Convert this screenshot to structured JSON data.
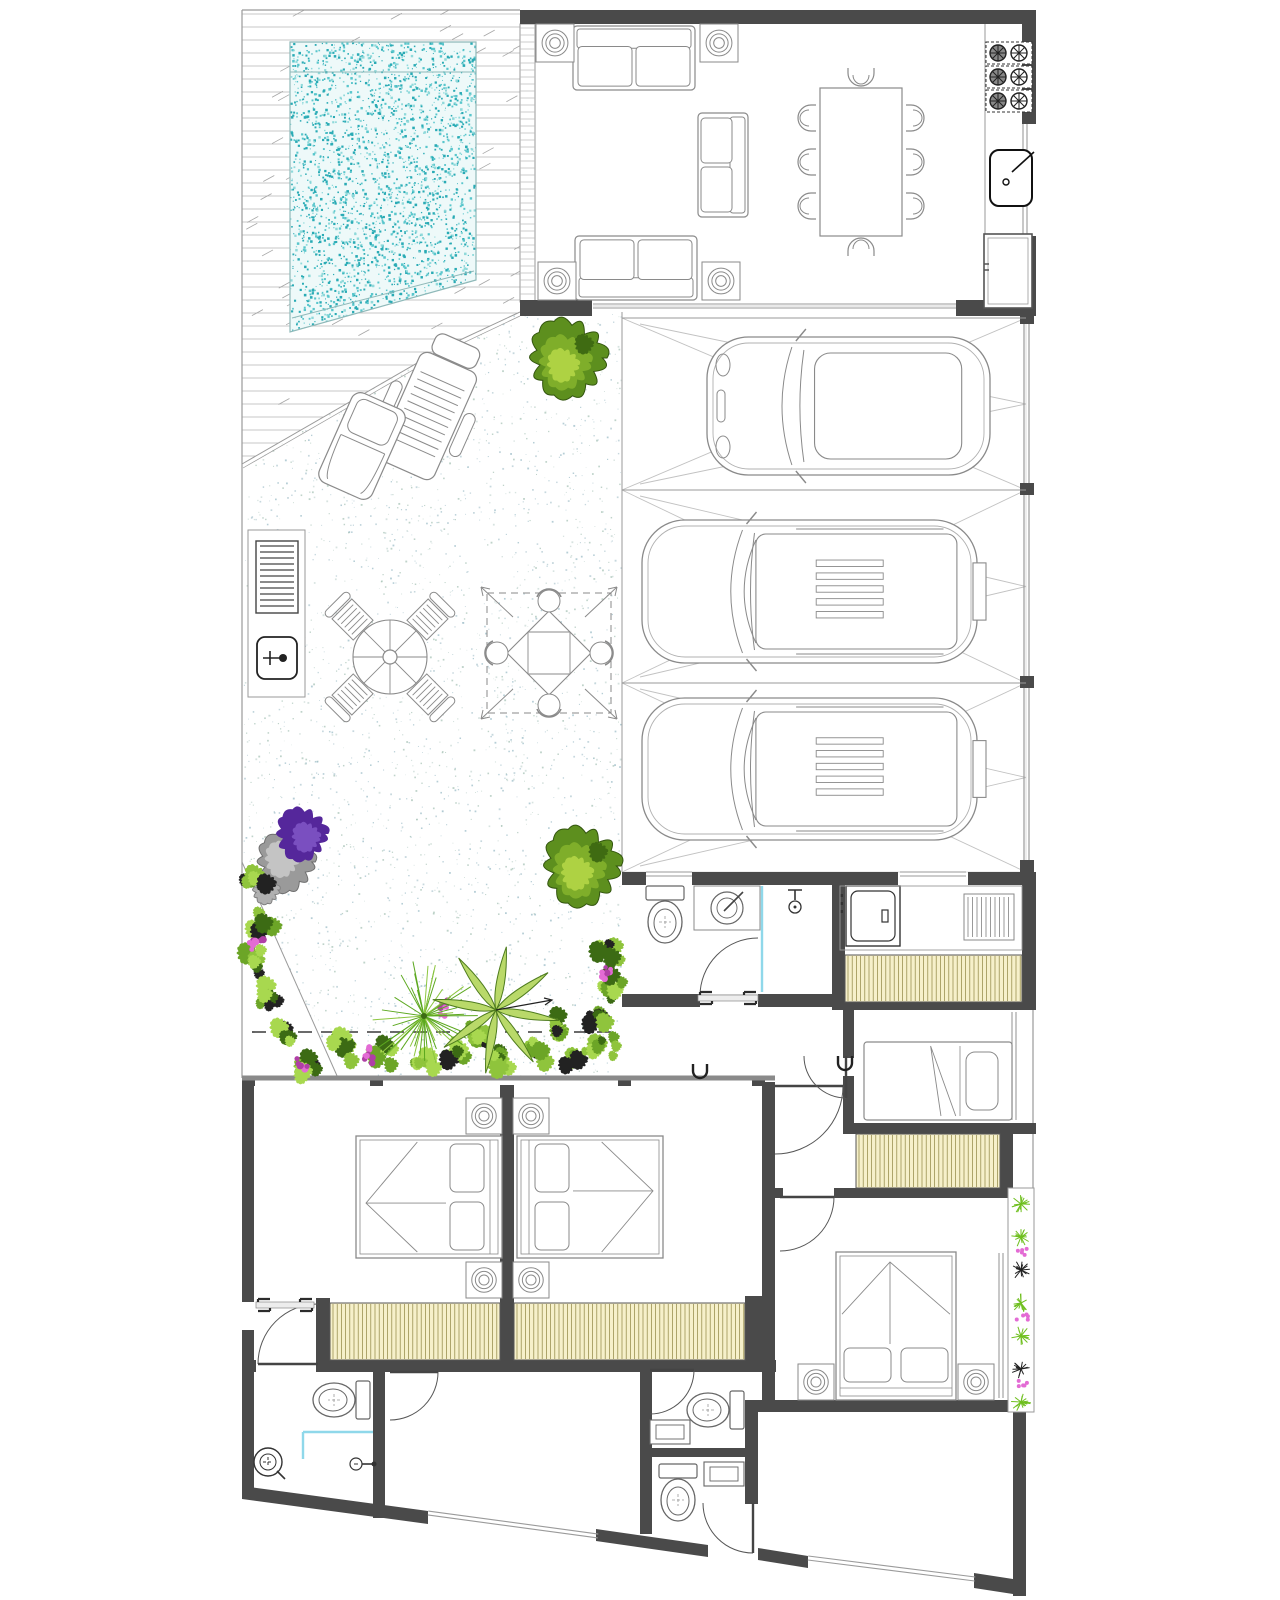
{
  "canvas": {
    "w": 1280,
    "h": 1600,
    "bg": "#ffffff"
  },
  "palette": {
    "wall": "#4a4a4a",
    "thin": "#9a9a9a",
    "mid": "#8a8a8a",
    "furn": "#8a8a8a",
    "furn2": "#666666",
    "poolBase": "#eef9f9",
    "poolDot1": "#2aabb5",
    "poolDot2": "#59c6cc",
    "poolDot3": "#8fd9da",
    "poolEdge": "#8fb9b9",
    "deckLine": "#b5b5b5",
    "deckTick": "#a6a6a6",
    "patioDots": [
      "#a9c3cd",
      "#9cbcae",
      "#c2d4cf",
      "#8fb3c0"
    ],
    "bayLine": "#c2c2c2",
    "gate": "#9a9a9a",
    "closetBg": "#f6f0ca",
    "closetLine": "#8e8440",
    "closetEdge": "#555555",
    "cyan": "#8fd8ea",
    "dash": "#3a3a3a",
    "treeDark": "#5d8f1e",
    "treeMid": "#7fae2a",
    "treeLight": "#aed243",
    "treeDeep": "#3f6b12",
    "bushGreens": [
      "#8fc43c",
      "#6ca527",
      "#a8d84f",
      "#3c6b14",
      "#222222"
    ],
    "pink": "#e36bd4",
    "pink2": "#b03fa6",
    "purple": "#55279b",
    "purple2": "#7a4fc0",
    "rock1": "#9a9a9a",
    "rock2": "#c4c4c4",
    "door": "#555555",
    "leaf": "#444444"
  },
  "site": {
    "topEdge": [
      242,
      10,
      520,
      10
    ],
    "leftEdge": [
      242,
      10,
      242,
      1078
    ],
    "rightThin": [
      1033,
      1006,
      1033,
      1192
    ],
    "gardenCutLine": [
      242,
      862,
      338,
      1078
    ],
    "dashedLine": [
      252,
      1032,
      612,
      1032
    ]
  },
  "floors": {
    "deck": {
      "poly": [
        [
          242,
          10
        ],
        [
          520,
          10
        ],
        [
          520,
          312
        ],
        [
          445,
          347
        ],
        [
          242,
          464
        ]
      ],
      "edge1": [
        [
          520,
          312
        ],
        [
          445,
          347
        ],
        [
          242,
          464
        ]
      ],
      "edge2": [
        [
          520,
          316
        ],
        [
          446,
          351
        ],
        [
          243,
          468
        ]
      ],
      "lineStep": 13,
      "ticks": 80
    },
    "pool": {
      "poly": [
        [
          290,
          42
        ],
        [
          476,
          42
        ],
        [
          476,
          280
        ],
        [
          290,
          332
        ]
      ],
      "steps": [
        [
          290,
          72,
          476,
          72
        ],
        [
          292,
          318,
          474,
          271
        ]
      ],
      "dots": 2600
    },
    "patio": {
      "poly": [
        [
          242,
          464
        ],
        [
          445,
          347
        ],
        [
          520,
          312
        ],
        [
          622,
          312
        ],
        [
          622,
          1078
        ],
        [
          242,
          1078
        ]
      ],
      "dots": 3000
    },
    "whiteCut": {
      "poly": [
        [
          242,
          862
        ],
        [
          338,
          1078
        ],
        [
          242,
          1078
        ]
      ]
    },
    "louver": {
      "x": 520,
      "y": 24,
      "w": 15,
      "h": 278,
      "step": 7
    },
    "garage": {
      "x0": 622,
      "x1": 1026,
      "bays": [
        [
          318,
          490
        ],
        [
          490,
          683
        ],
        [
          683,
          872
        ]
      ]
    },
    "gates": {
      "lines": [
        [
          1024,
          318,
          1024,
          872
        ],
        [
          1029,
          318,
          1029,
          872
        ]
      ],
      "posts": [
        [
          1020,
          312,
          14,
          12
        ],
        [
          1020,
          483,
          14,
          12
        ],
        [
          1020,
          676,
          14,
          12
        ],
        [
          1020,
          860,
          14,
          12
        ]
      ]
    },
    "slidingGlass": {
      "x1": 593,
      "x2": 956,
      "y": 306
    }
  },
  "walls": [
    [
      520,
      10,
      516,
      14
    ],
    [
      1022,
      10,
      14,
      114
    ],
    [
      1022,
      236,
      14,
      80
    ],
    [
      520,
      300,
      72,
      16
    ],
    [
      956,
      300,
      80,
      16
    ],
    [
      622,
      872,
      24,
      13
    ],
    [
      692,
      872,
      206,
      13
    ],
    [
      968,
      872,
      68,
      13
    ],
    [
      832,
      885,
      13,
      110
    ],
    [
      622,
      994,
      78,
      13
    ],
    [
      758,
      994,
      74,
      13
    ],
    [
      1022,
      885,
      14,
      121
    ],
    [
      832,
      950,
      13,
      58
    ],
    [
      832,
      1002,
      204,
      8
    ],
    [
      843,
      1010,
      11,
      48
    ],
    [
      843,
      1076,
      11,
      49
    ],
    [
      843,
      1123,
      193,
      11
    ],
    [
      1000,
      1134,
      13,
      56
    ],
    [
      775,
      1188,
      8,
      10
    ],
    [
      834,
      1188,
      188,
      10
    ],
    [
      762,
      1082,
      13,
      330
    ],
    [
      500,
      1085,
      14,
      280
    ],
    [
      242,
      1082,
      12,
      220
    ],
    [
      242,
      1330,
      12,
      36
    ],
    [
      242,
      1360,
      14,
      12
    ],
    [
      316,
      1360,
      460,
      12
    ],
    [
      316,
      1298,
      14,
      74
    ],
    [
      745,
      1296,
      17,
      76
    ],
    [
      745,
      1400,
      277,
      12
    ],
    [
      242,
      1368,
      12,
      122
    ],
    [
      373,
      1368,
      12,
      150
    ],
    [
      640,
      1368,
      12,
      88
    ],
    [
      640,
      1448,
      105,
      9
    ],
    [
      640,
      1452,
      12,
      82
    ],
    [
      745,
      1412,
      13,
      92
    ],
    [
      1013,
      1412,
      13,
      184
    ],
    [
      242,
      1076,
      13,
      10
    ],
    [
      370,
      1076,
      13,
      10
    ],
    [
      618,
      1076,
      13,
      10
    ],
    [
      752,
      1076,
      13,
      10
    ]
  ],
  "wallPolys": [
    [
      [
        242,
        1486
      ],
      [
        428,
        1511
      ],
      [
        428,
        1524
      ],
      [
        242,
        1499
      ]
    ],
    [
      [
        596,
        1529
      ],
      [
        708,
        1545
      ],
      [
        708,
        1557
      ],
      [
        596,
        1541
      ]
    ],
    [
      [
        758,
        1548
      ],
      [
        808,
        1556
      ],
      [
        808,
        1568
      ],
      [
        758,
        1560
      ]
    ],
    [
      [
        974,
        1573
      ],
      [
        1026,
        1581
      ],
      [
        1026,
        1596
      ],
      [
        974,
        1588
      ]
    ]
  ],
  "grayWalls": [
    [
      242,
      1078,
      775,
      1078
    ]
  ],
  "windows": [
    [
      1025,
      124,
      1025,
      236
    ],
    [
      646,
      874,
      692,
      874
    ],
    [
      900,
      874,
      966,
      874
    ],
    [
      1014,
      1012,
      1014,
      1120
    ],
    [
      1001,
      1253,
      1001,
      1398
    ],
    [
      428,
      1513,
      598,
      1536
    ],
    [
      808,
      1558,
      975,
      1579
    ]
  ],
  "thin": [
    [
      622,
      312,
      622,
      872
    ],
    [
      985,
      24,
      985,
      300
    ],
    [
      622,
      318,
      1026,
      318
    ],
    [
      622,
      490,
      1026,
      490
    ],
    [
      622,
      683,
      1026,
      683
    ]
  ],
  "cyan": [
    [
      762,
      886,
      762,
      992
    ],
    [
      303,
      1432,
      373,
      1432
    ],
    [
      303,
      1432,
      303,
      1459
    ]
  ],
  "closets": [
    [
      845,
      955,
      177,
      47
    ],
    [
      856,
      1134,
      144,
      54
    ],
    [
      330,
      1303,
      170,
      57
    ],
    [
      514,
      1303,
      231,
      57
    ]
  ],
  "doors": [
    {
      "hx": 758,
      "hy": 996,
      "r": 58,
      "a0": 180,
      "a1": 270
    },
    {
      "hx": 775,
      "hy": 1086,
      "r": 68,
      "a0": 0,
      "a1": 90
    },
    {
      "hx": 846,
      "hy": 1056,
      "r": 42,
      "a0": 90,
      "a1": 180
    },
    {
      "hx": 780,
      "hy": 1197,
      "r": 54,
      "a0": 0,
      "a1": 90
    },
    {
      "hx": 318,
      "hy": 1364,
      "r": 60,
      "a0": 180,
      "a1": 270
    },
    {
      "hx": 390,
      "hy": 1372,
      "r": 48,
      "a0": 0,
      "a1": 90
    },
    {
      "hx": 650,
      "hy": 1370,
      "r": 44,
      "a0": 0,
      "a1": 90
    },
    {
      "hx": 753,
      "hy": 1503,
      "r": 50,
      "a0": 90,
      "a1": 180
    }
  ],
  "sliders": [
    {
      "x": 698,
      "y": 998,
      "len": 60
    },
    {
      "x": 256,
      "y": 1305,
      "len": 58
    }
  ],
  "furniture": [
    {
      "t": "sofa",
      "cx": 634,
      "cy": 58,
      "L": 122,
      "W": 64,
      "rot": 0
    },
    {
      "t": "sofa",
      "cx": 636,
      "cy": 268,
      "L": 122,
      "W": 64,
      "rot": 180
    },
    {
      "t": "sofa",
      "cx": 723,
      "cy": 165,
      "L": 104,
      "W": 50,
      "rot": 90
    },
    {
      "t": "lt",
      "x": 536,
      "y": 24,
      "s": 38
    },
    {
      "t": "lt",
      "x": 700,
      "y": 24,
      "s": 38
    },
    {
      "t": "lt",
      "x": 538,
      "y": 262,
      "s": 38
    },
    {
      "t": "lt",
      "x": 702,
      "y": 262,
      "s": 38
    },
    {
      "t": "lt",
      "x": 466,
      "y": 1098,
      "s": 36
    },
    {
      "t": "lt",
      "x": 466,
      "y": 1262,
      "s": 36
    },
    {
      "t": "lt",
      "x": 513,
      "y": 1098,
      "s": 36
    },
    {
      "t": "lt",
      "x": 513,
      "y": 1262,
      "s": 36
    },
    {
      "t": "lt",
      "x": 798,
      "y": 1364,
      "s": 36
    },
    {
      "t": "lt",
      "x": 958,
      "y": 1364,
      "s": 36
    },
    {
      "t": "dining",
      "x": 820,
      "y": 88,
      "w": 82,
      "h": 148
    },
    {
      "t": "stove",
      "x": 986,
      "y": 42
    },
    {
      "t": "ksink",
      "x": 990,
      "y": 150
    },
    {
      "t": "fridge",
      "x": 984,
      "y": 234
    },
    {
      "t": "counter",
      "x": 248,
      "y": 530,
      "w": 57,
      "h": 167
    },
    {
      "t": "grill",
      "x": 256,
      "y": 541,
      "w": 42,
      "h": 72
    },
    {
      "t": "osink",
      "x": 257,
      "y": 637,
      "w": 40,
      "h": 42
    },
    {
      "t": "lounger",
      "cx": 427,
      "cy": 416,
      "rot": 24
    },
    {
      "t": "recliner",
      "cx": 362,
      "cy": 446,
      "rot": 24
    },
    {
      "t": "roundset",
      "cx": 390,
      "cy": 657
    },
    {
      "t": "sailset",
      "cx": 549,
      "cy": 653
    },
    {
      "t": "toilet",
      "cx": 665,
      "cy": 916,
      "rot": 0
    },
    {
      "t": "basin",
      "x": 694,
      "y": 886,
      "w": 66,
      "h": 44
    },
    {
      "t": "shower",
      "x": 795,
      "y": 890
    },
    {
      "t": "washer",
      "x": 846,
      "y": 886
    },
    {
      "t": "grate",
      "x": 964,
      "y": 894
    },
    {
      "t": "lcounter",
      "x": 840,
      "y": 886,
      "w": 182,
      "h": 64
    },
    {
      "t": "bedD",
      "cx": 429,
      "cy": 1197,
      "L": 146,
      "W": 122,
      "rot": 0
    },
    {
      "t": "bedD",
      "cx": 590,
      "cy": 1197,
      "L": 146,
      "W": 122,
      "rot": 180
    },
    {
      "t": "bedS",
      "cx": 938,
      "cy": 1081,
      "L": 148,
      "W": 78,
      "rot": 0
    },
    {
      "t": "bedD",
      "cx": 896,
      "cy": 1326,
      "L": 148,
      "W": 120,
      "rot": 90
    },
    {
      "t": "toilet",
      "cx": 340,
      "cy": 1400,
      "rot": 90
    },
    {
      "t": "toilet",
      "cx": 714,
      "cy": 1410,
      "rot": 90
    },
    {
      "t": "toilet",
      "cx": 678,
      "cy": 1494,
      "rot": 0
    },
    {
      "t": "vanity",
      "x": 650,
      "y": 1420,
      "w": 40,
      "h": 24
    },
    {
      "t": "vanity",
      "x": 704,
      "y": 1462,
      "w": 40,
      "h": 24
    },
    {
      "t": "drain",
      "cx": 268,
      "cy": 1462
    },
    {
      "t": "faucet",
      "cx": 356,
      "cy": 1464
    },
    {
      "t": "uh",
      "cx": 845,
      "cy": 1062
    },
    {
      "t": "uh",
      "cx": 700,
      "cy": 1070
    }
  ],
  "cars": [
    {
      "x": 707,
      "y": 337,
      "w": 283,
      "h": 138,
      "kind": "beetle"
    },
    {
      "x": 642,
      "y": 520,
      "w": 335,
      "h": 143,
      "kind": "suv",
      "box": true
    },
    {
      "x": 642,
      "y": 698,
      "w": 335,
      "h": 142,
      "kind": "suv",
      "box": true
    }
  ],
  "plants": {
    "trees": [
      [
        568,
        358,
        40
      ],
      [
        582,
        866,
        40
      ]
    ],
    "palmFan": [
      [
        424,
        1016,
        58
      ]
    ],
    "palmLeaf": [
      [
        496,
        1010,
        64
      ]
    ],
    "rock": [
      286,
      862,
      30
    ],
    "rock2": [
      266,
      890,
      14
    ],
    "purple": [
      302,
      834,
      27
    ],
    "bushes": [
      [
        258,
        878
      ],
      [
        264,
        920
      ],
      [
        256,
        960
      ],
      [
        270,
        998
      ],
      [
        286,
        1038
      ],
      [
        304,
        1066
      ],
      [
        345,
        1048
      ],
      [
        382,
        1056
      ],
      [
        420,
        1062
      ],
      [
        458,
        1052
      ],
      [
        500,
        1060
      ],
      [
        540,
        1050
      ],
      [
        575,
        1058
      ],
      [
        605,
        1048
      ],
      [
        608,
        950
      ],
      [
        612,
        988
      ],
      [
        600,
        1020
      ],
      [
        560,
        1030
      ],
      [
        480,
        1035
      ]
    ],
    "pinks": [
      [
        368,
        1054
      ],
      [
        300,
        1066
      ],
      [
        446,
        1008
      ],
      [
        608,
        972
      ],
      [
        256,
        942
      ]
    ],
    "planter": {
      "x": 1008,
      "y": 1188,
      "w": 26,
      "h": 224
    }
  }
}
